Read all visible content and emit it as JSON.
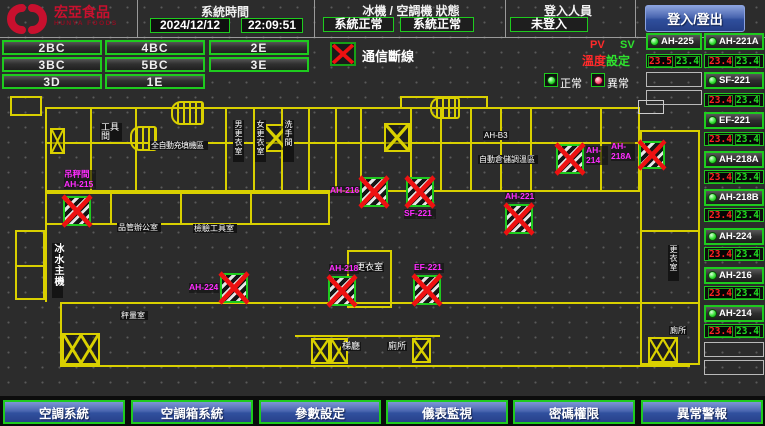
{
  "header": {
    "logo": {
      "title": "宏亞食品",
      "subtitle": "HUNYA FOODS"
    },
    "system_time": {
      "label": "系統時間",
      "date": "2024/12/12",
      "time": "22:09:51"
    },
    "machine_status": {
      "label": "冰機 / 空調機 狀態",
      "chiller_status": "系統正常",
      "ac_status": "系統正常"
    },
    "login": {
      "label": "登入人員",
      "value": "未登入",
      "button": "登入/登出"
    }
  },
  "floors": [
    "2BC",
    "4BC",
    "2E",
    "3BC",
    "5BC",
    "3E",
    "3D",
    "1E"
  ],
  "legend": {
    "comm_fail": "通信斷線",
    "pv": "PV",
    "sv": "SV",
    "temp": "溫度",
    "setting": "設定",
    "normal": "正常",
    "abnormal": "異常"
  },
  "units": [
    {
      "name": "AH-225",
      "pv": "23.5",
      "sv": "23.4"
    },
    {
      "name": "AH-221A",
      "pv": "23.4",
      "sv": "23.4"
    },
    {
      "name": "SF-221",
      "pv": "23.4",
      "sv": "23.4"
    },
    {
      "name": "EF-221",
      "pv": "23.4",
      "sv": "23.4"
    },
    {
      "name": "AH-218A",
      "pv": "23.4",
      "sv": "23.4"
    },
    {
      "name": "AH-218B",
      "pv": "23.4",
      "sv": "23.4"
    },
    {
      "name": "AH-224",
      "pv": "23.4",
      "sv": "23.4"
    },
    {
      "name": "AH-216",
      "pv": "23.4",
      "sv": "23.4"
    },
    {
      "name": "AH-214",
      "pv": "23.4",
      "sv": "23.4"
    }
  ],
  "map": {
    "room_labels": [
      "工具間",
      "全自動充填機區",
      "男更衣室",
      "女更衣室",
      "洗手間",
      "AH-B3",
      "自動倉儲調溫區",
      "冰水主機",
      "品管辦公室",
      "檢驗工具室",
      "秤量室",
      "更衣室",
      "梯廳",
      "廁所",
      "更衣室",
      "廁所"
    ],
    "devices": [
      {
        "room": "吊秤間",
        "name": "AH-215"
      },
      {
        "name": "AH-224"
      },
      {
        "name": "AH-216"
      },
      {
        "name": "SF-221"
      },
      {
        "name": "AH-218"
      },
      {
        "name": "EF-221"
      },
      {
        "name": "AH-221"
      },
      {
        "name": "AH-214"
      },
      {
        "name": "AH-218A"
      }
    ]
  },
  "footer": [
    "空調系統",
    "空調箱系統",
    "參數設定",
    "儀表監視",
    "密碼權限",
    "異常警報"
  ],
  "colors": {
    "accent_green": "#1ECB1E",
    "alarm_red": "#EE1111",
    "device_magenta": "#FF2CFF",
    "wall_yellow": "#D9D000",
    "button_blue": "#31509E"
  }
}
